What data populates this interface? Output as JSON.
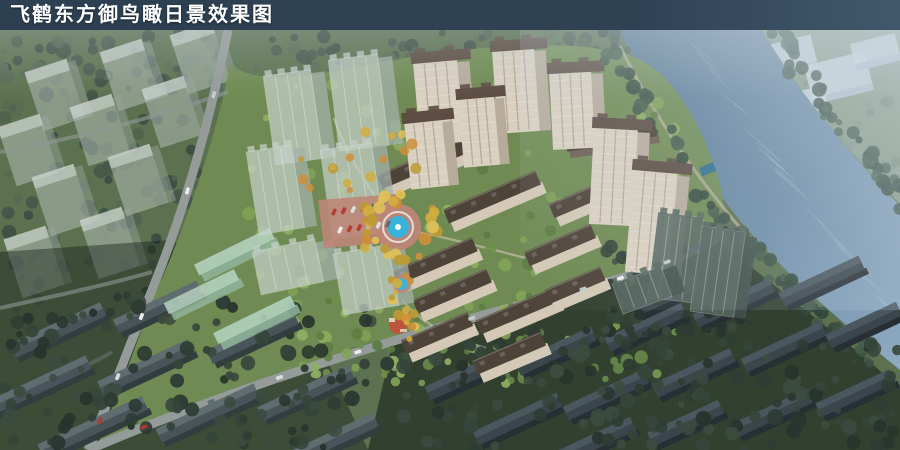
{
  "header": {
    "title": "飞鹤东方御鸟瞰日景效果图",
    "bar_color": "#2e4254",
    "text_color": "#ffffff"
  },
  "scene": {
    "palette": {
      "ground": "#5c714f",
      "dev_ground": "#6f8a52",
      "water_deep": "#54748e",
      "water_light": "#8fabc2",
      "haze": "#cfdde9",
      "road": "#949b99",
      "path": "#cfc6b3",
      "promenade": "#b5ae9c",
      "tower_face": "#d9d0c0",
      "tower_side": "#b7ac9a",
      "tower_roof": "#5c4c42",
      "row_face": "#d3c9b6",
      "row_roof": "#4e4339",
      "clubhouse_roof": "#4a3f37",
      "clubhouse_face": "#6b5c50",
      "glass_face": "#c6d0c9",
      "glass_side": "#a4b2ab",
      "dark_glass_face": "#56665f",
      "dark_glass_side": "#43524c",
      "green_glass_roof": "#b7d3c2",
      "green_glass_face": "#8fb49a",
      "ghost_face": "#ccd5dd",
      "ghost_side": "#aeb9c4",
      "context_slab_face": "#b9c3be",
      "context_slab_top": "#d0d8d3",
      "gable_roof_lit": "#5f6c70",
      "gable_roof_shade": "#49545a",
      "gable_face": "#323d3f",
      "dark_row_roof_lit": "#4b575f",
      "dark_row_roof_shade": "#3a454c",
      "dark_row_face": "#272f35",
      "plaza_paving": "#bd8578",
      "plaza_ring": "#e8ddd2",
      "pool_water": "#3bb2da",
      "fountain_jet": "#f2f8f8",
      "playground_red": "#c2503a",
      "playground_orange": "#e0913c",
      "car_colors": [
        "#f2f2f2",
        "#dde2e4",
        "#c7cdd0",
        "#b23a2e",
        "#5b6b77"
      ],
      "trees_context": [
        "#46584a",
        "#50634f",
        "#3d4f43",
        "#576a54"
      ],
      "trees_dark": [
        "#2e3c34",
        "#35453a",
        "#28342d",
        "#3b4b3f"
      ],
      "trees_haze": [
        "#7c8f7f",
        "#8a9c8c",
        "#6f836f"
      ],
      "trees_dev": [
        "#6d8f4e",
        "#7fa457",
        "#5d7c42",
        "#8fae62"
      ],
      "trees_bank": [
        "#3c5244",
        "#445c4a",
        "#33483c"
      ],
      "trees_gold": [
        "#d2ae3e",
        "#e0c158",
        "#bd9a33",
        "#cc8f3a"
      ]
    }
  }
}
